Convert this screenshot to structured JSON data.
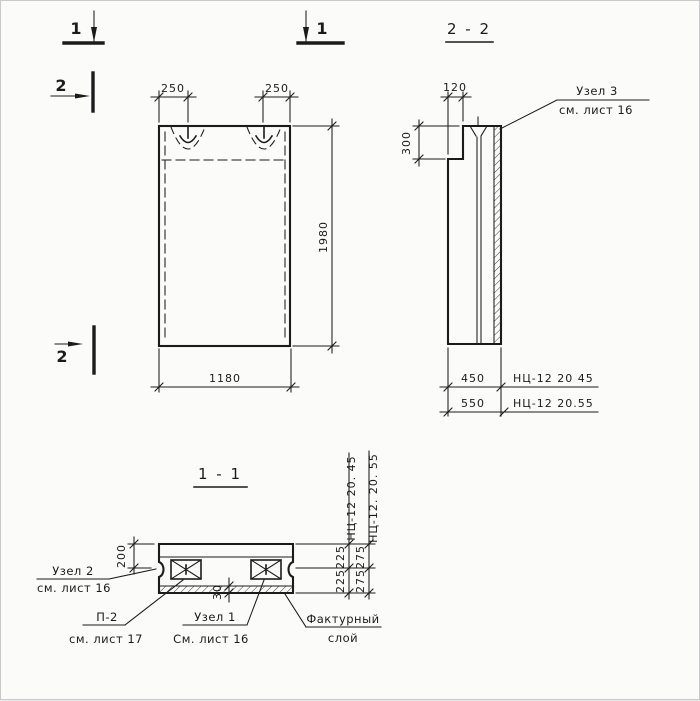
{
  "markers": {
    "cut1_left": "1",
    "cut1_right": "1",
    "cut2_top": "2",
    "cut2_bottom": "2"
  },
  "elevation": {
    "dim_loop_left": "250",
    "dim_loop_right": "250",
    "dim_width": "1180",
    "dim_height": "1980"
  },
  "section22": {
    "title": "2 - 2",
    "dim_step_width": "120",
    "dim_step_height": "300",
    "dim_thickness_450": "450",
    "dim_thickness_550": "550",
    "mark_450": "НЦ-12 20 45",
    "mark_550": "НЦ-12 20.55",
    "callout_uzel3_line1": "Узел 3",
    "callout_uzel3_line2": "см. лист 16"
  },
  "section11": {
    "title": "1 - 1",
    "dim_top_offset": "200",
    "dim_layer": "30",
    "dim_half45_a": "225",
    "dim_half45_b": "225",
    "dim_half55_a": "275",
    "dim_half55_b": "275",
    "mark_450": "НЦ-12 20. 45",
    "mark_550": "НЦ-12. 20. 55",
    "callout_uzel2_line1": "Узел 2",
    "callout_uzel2_line2": "см. лист 16",
    "callout_p2_line1": "П-2",
    "callout_p2_line2": "см. лист 17",
    "callout_uzel1_line1": "Узел 1",
    "callout_uzel1_line2": "См. лист 16",
    "callout_factured_line1": "Фактурный",
    "callout_factured_line2": "слой"
  },
  "colors": {
    "ink": "#1b1b1b",
    "paper": "#fbfbf9"
  }
}
